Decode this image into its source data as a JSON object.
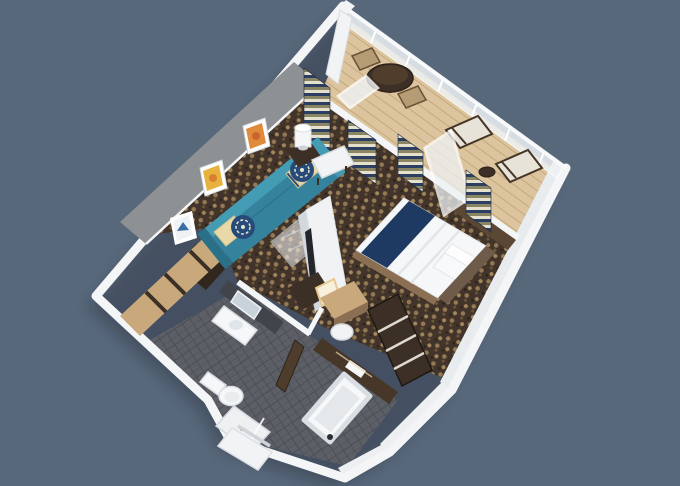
{
  "scene": {
    "type": "3d-isometric-floorplan-render",
    "subject": "hotel suite cutaway floor plan with balcony",
    "rooms": [
      {
        "name": "balcony",
        "items": [
          "wood-deck",
          "glass-balustrade",
          "bistro-table",
          "bistro-chair-left",
          "bistro-chair-right",
          "lounge-chair-upper",
          "lounge-chair-lower",
          "lounge-side-table",
          "privacy-divider"
        ]
      },
      {
        "name": "living-area",
        "items": [
          "patterned-carpet",
          "teal-sofa",
          "cream-pillows",
          "navy-pattern-pillows",
          "glass-coffee-table",
          "side-table",
          "table-lamp",
          "orange-wall-art",
          "amber-wall-art",
          "framed-print",
          "tv-partition",
          "media-console",
          "bench-seat",
          "accent-wall"
        ]
      },
      {
        "name": "bedroom",
        "items": [
          "double-bed",
          "navy-bed-runner",
          "white-duvet",
          "bed-pillows",
          "headboard",
          "bed-platform",
          "vanity-desk",
          "stool",
          "lit-mirror",
          "wardrobe-shelves",
          "window-sill-console",
          "balcony-door"
        ]
      },
      {
        "name": "dressing-area",
        "items": [
          "sliding-door-closet",
          "storage-nook"
        ]
      },
      {
        "name": "bathroom",
        "items": [
          "vanity-sink",
          "vanity-mirror",
          "tiled-wall",
          "toilet",
          "shower",
          "bathtub",
          "bath-door",
          "towel-shelf"
        ]
      },
      {
        "name": "entry",
        "items": [
          "entry-landing",
          "entry-door"
        ]
      }
    ]
  },
  "colors": {
    "background": "#58687b",
    "wall": "#f4f5f6",
    "wall_shade": "#e9ecef",
    "wall_shade2": "#edeff2",
    "accent_wall": "#8e9194",
    "carpet_base": "#42342a",
    "carpet_motif": "#a78b5f",
    "tile": "#5c5f66",
    "tile_grout": "#4b4e55",
    "deck": "#dcc49e",
    "deck_line": "#c4a87c",
    "glass": "#eef3f6",
    "sofa": "#35829d",
    "sofa_back": "#449bb4",
    "sofa_dark": "#2a7089",
    "pillow_cream": "#ead9a8",
    "pillow_navy": "#274b79",
    "bed_white": "#f6f7f8",
    "bed_navy": "#1f3a62",
    "headboard": "#6e5b49",
    "wood_light": "#c9a97c",
    "wood_mid": "#8a6f52",
    "wood_dark": "#3c3026",
    "wood_tan": "#b59c74",
    "bath_wall": "#473729",
    "tile_dark": "#41444b",
    "porcelain": "#f5f7f8",
    "door_brown": "#4e3d2c",
    "curtain_navy": "#2c3f63",
    "curtain_olive": "#8a8562",
    "curtain_cream": "#e6e1cd",
    "art_orange": "#e08a3c",
    "art_amber": "#e8b23e",
    "art_blue": "#3a6ea8",
    "lounger": "#e7e3d8",
    "tv_black": "#23262a",
    "mirror_glow": "#f8efdc",
    "sill": "#5a4734"
  }
}
